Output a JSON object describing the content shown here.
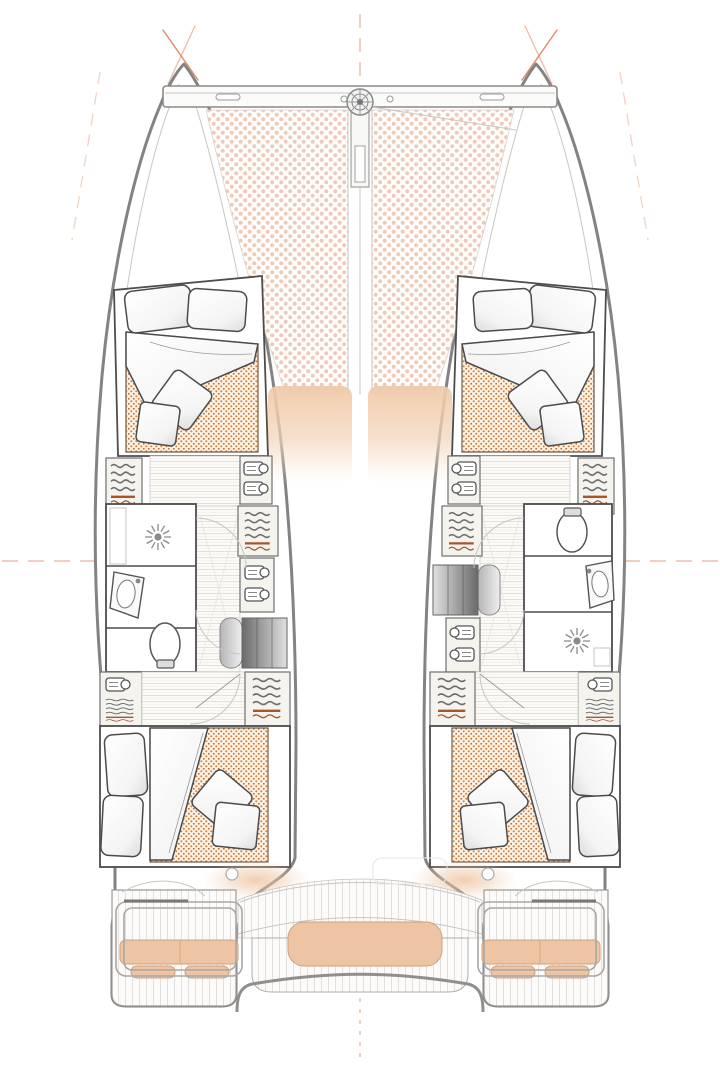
{
  "plan": {
    "vessel_type": "catamaran-accommodation-plan",
    "bow": {
      "trampoline": "trampoline-net",
      "crossbeam": "forward-crossbeam",
      "windlass": "anchor-windlass",
      "bowsprit": "bowsprit-channel",
      "sunpads": [
        "port-foredeck-pad",
        "starboard-foredeck-pad"
      ]
    },
    "port_hull": {
      "forward_cabin": {
        "bed": "double-berth",
        "pillows": 2,
        "cushions": 2,
        "duvet": "folded-duvet"
      },
      "head": {
        "fixtures": [
          "shower",
          "washbasin",
          "toilet"
        ]
      },
      "lockers": [
        "hanging-locker",
        "shelved-locker",
        "hanging-locker",
        "shelved-locker"
      ],
      "companionway": "steps-down",
      "aft_cabin": {
        "bed": "double-berth",
        "pillows": 2,
        "cushions": 2,
        "duvet": "folded-duvet"
      }
    },
    "starboard_hull": {
      "forward_cabin": {
        "bed": "double-berth",
        "pillows": 2,
        "cushions": 2,
        "duvet": "folded-duvet"
      },
      "head": {
        "fixtures": [
          "toilet",
          "washbasin",
          "shower"
        ]
      },
      "lockers": [
        "hanging-locker",
        "shelved-locker",
        "hanging-locker",
        "shelved-locker"
      ],
      "companionway": "steps-down",
      "aft_cabin": {
        "bed": "double-berth",
        "pillows": 2,
        "cushions": 2,
        "duvet": "folded-duvet"
      }
    },
    "cockpit": {
      "center_bench": "cushioned-bench",
      "stern_benches": [
        "port-stern-bench",
        "starboard-stern-bench"
      ],
      "guardrails": 2,
      "engine_hatches": 2,
      "transom_platforms": 2,
      "table_ghost": "cockpit-table-outline"
    }
  },
  "colors": {
    "outline": "#838383",
    "wall": "#4d4d4d",
    "rigging": "#e08a64",
    "dash_orange": "#e8b49c",
    "cushion_tan": "#edc5a4",
    "cushion_edge": "#cf9f78",
    "mattress_dot": "#d8853e",
    "trampoline_dot": "#eecab9",
    "hanger_rust": "#a8552a",
    "wood_line": "#ded9d2",
    "steps_dark": "#6a6a6a"
  }
}
